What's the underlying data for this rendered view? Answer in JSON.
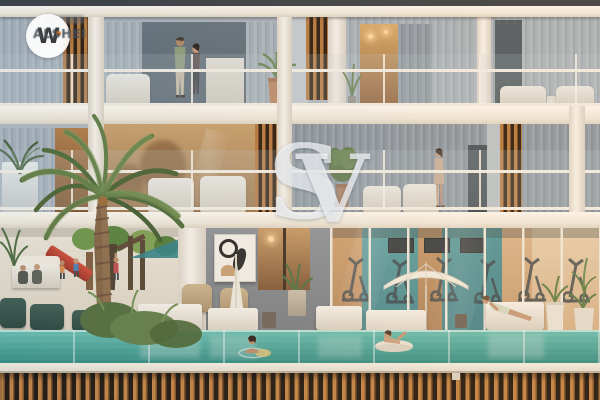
{
  "meta": {
    "type": "architectural-render",
    "description": "Dusk exterior rendering of a modern residential building cross-section: two apartment floors with glass balconies and curtains above an amenity podium containing a kids' playground with red slide, lounge seating, an abstract-art wall, a glass-walled gym with exercise machines, sun loungers with white umbrellas and an elevated glass-edged turquoise pool with swimmers, fronted by a tall palm tree; dark timber-slat podium wall below."
  },
  "watermarks": {
    "logo": {
      "monogram": "W",
      "brand": "ALSHEI"
    },
    "center": {
      "s": "S",
      "v": "V"
    }
  },
  "palette": {
    "facade": "#aeb8c1",
    "slab-white": "#f3efe8",
    "wood-slat": "#b5763a",
    "podium-dark": "#17110a",
    "pool-teal": "#3fa195",
    "gym-teal": "#3b8d90",
    "interior-tan": "#bf9668",
    "playground-green": "#5c8a3c",
    "slide-red": "#c4402f",
    "curtain-gray": "#9aa6b1",
    "logo-text": "#414b55",
    "logo-accent": "#d97b2e",
    "watermark-white": "#ffffff"
  },
  "scene": {
    "elements": [
      "palm-tree",
      "balcony-couple",
      "balcony-woman",
      "glass-railings",
      "curtains",
      "wood-slat-screens",
      "kids-playground",
      "red-slide",
      "outdoor-lounge",
      "abstract-artwork",
      "gym-equipment",
      "sun-loungers",
      "pool-umbrellas",
      "swimming-pool",
      "swimmers",
      "potted-plants",
      "timber-slat-podium-wall"
    ]
  }
}
